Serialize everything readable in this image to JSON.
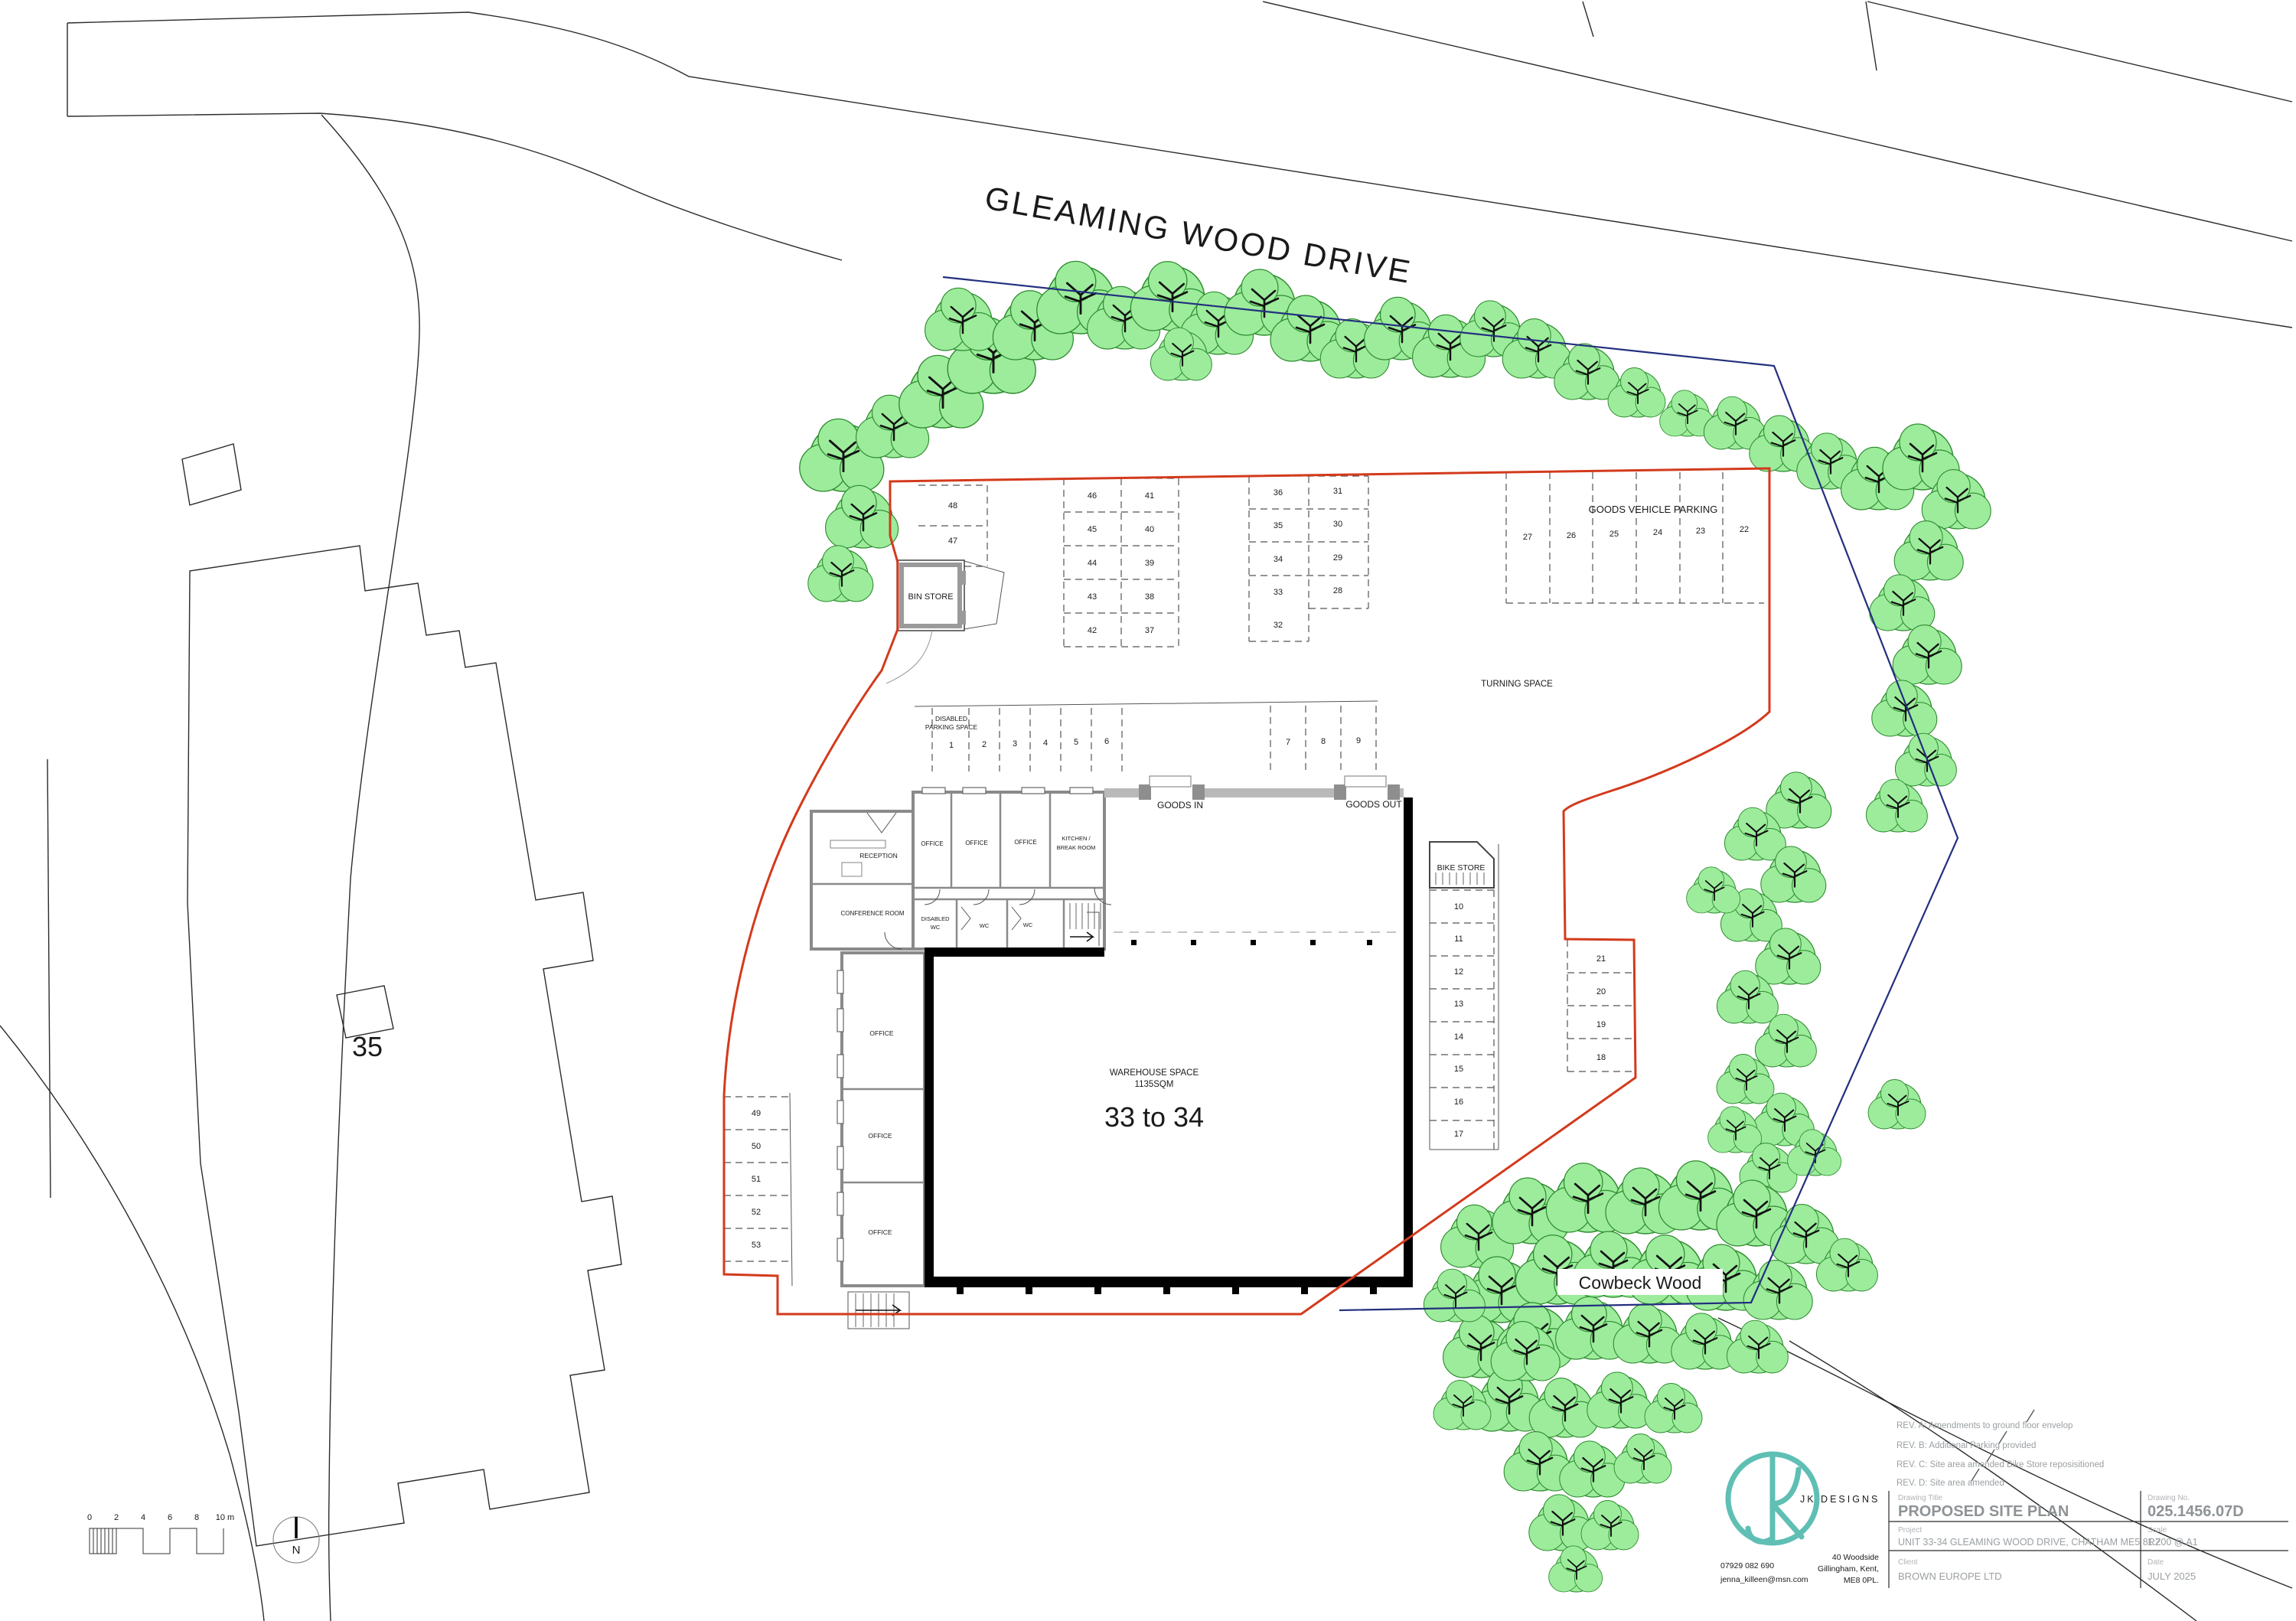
{
  "plan": {
    "road_name": "GLEAMING WOOD DRIVE",
    "neighbor_label": "35",
    "wood_label": "Cowbeck Wood",
    "turning_space": "TURNING SPACE",
    "bin_store": "BIN STORE",
    "bike_store": "BIKE STORE",
    "goods_vehicle_parking": "GOODS VEHICLE PARKING",
    "goods_in": "GOODS IN",
    "goods_out": "GOODS OUT",
    "disabled_parking_line1": "DISABLED",
    "disabled_parking_line2": "PARKING SPACE",
    "warehouse_line1": "WAREHOUSE SPACE",
    "warehouse_line2": "1135SQM",
    "unit_range": "33 to 34",
    "north": "N",
    "rooms": {
      "reception": "RECEPTION",
      "office": "OFFICE",
      "kitchen1": "KITCHEN /",
      "kitchen2": "BREAK ROOM",
      "conference": "CONFERENCE ROOM",
      "disabled_wc1": "DISABLED",
      "disabled_wc2": "WC",
      "wc": "WC"
    },
    "parking": {
      "top_left": [
        "48",
        "47"
      ],
      "block_a_col1": [
        "46",
        "45",
        "44",
        "43",
        "42"
      ],
      "block_a_col2": [
        "41",
        "40",
        "39",
        "38",
        "37"
      ],
      "block_b_col1": [
        "36",
        "35",
        "34",
        "33",
        "32"
      ],
      "block_b_col2": [
        "31",
        "30",
        "29",
        "28"
      ],
      "goods": [
        "27",
        "26",
        "25",
        "24",
        "23",
        "22"
      ],
      "disabled_row": [
        "1",
        "2",
        "3",
        "4",
        "5",
        "6"
      ],
      "row_789": [
        "7",
        "8",
        "9"
      ],
      "bike_col": [
        "10",
        "11",
        "12",
        "13",
        "14",
        "15",
        "16",
        "17"
      ],
      "right_col": [
        "21",
        "20",
        "19",
        "18"
      ],
      "left_col": [
        "49",
        "50",
        "51",
        "52",
        "53"
      ]
    },
    "scalebar": [
      "0",
      "2",
      "4",
      "6",
      "8",
      "10 m"
    ]
  },
  "titleblock": {
    "revisions": [
      "REV. A: Amendments to ground floor envelop",
      "REV. B: Additional Parking provided",
      "REV. C: Site area amended Bike Store reposisitioned",
      "REV. D: Site area amended"
    ],
    "drawing_title_label": "Drawing Title",
    "drawing_title": "PROPOSED SITE PLAN",
    "drawing_no_label": "Drawing No.",
    "drawing_no": "025.1456.07D",
    "project_label": "Project",
    "project": "UNIT 33-34 GLEAMING WOOD DRIVE, CHATHAM ME5 8RZ",
    "scale_label": "Scale",
    "scale": "1:200 @ A1",
    "client_label": "Client",
    "client": "BROWN EUROPE LTD",
    "date_label": "Date",
    "date": "JULY 2025",
    "logo_text": "JK DESIGNS",
    "phone": "07929 082 690",
    "email": "jenna_killeen@msn.com",
    "address": [
      "40 Woodside",
      "Gillingham, Kent,",
      "ME8 0PL."
    ]
  },
  "colors": {
    "boundary_red": "#d33a1c",
    "boundary_blue": "#232f7e",
    "tree_fill": "#9cec9c",
    "tree_stroke": "#2e8b2e",
    "logo_teal": "#5fbfb4"
  }
}
